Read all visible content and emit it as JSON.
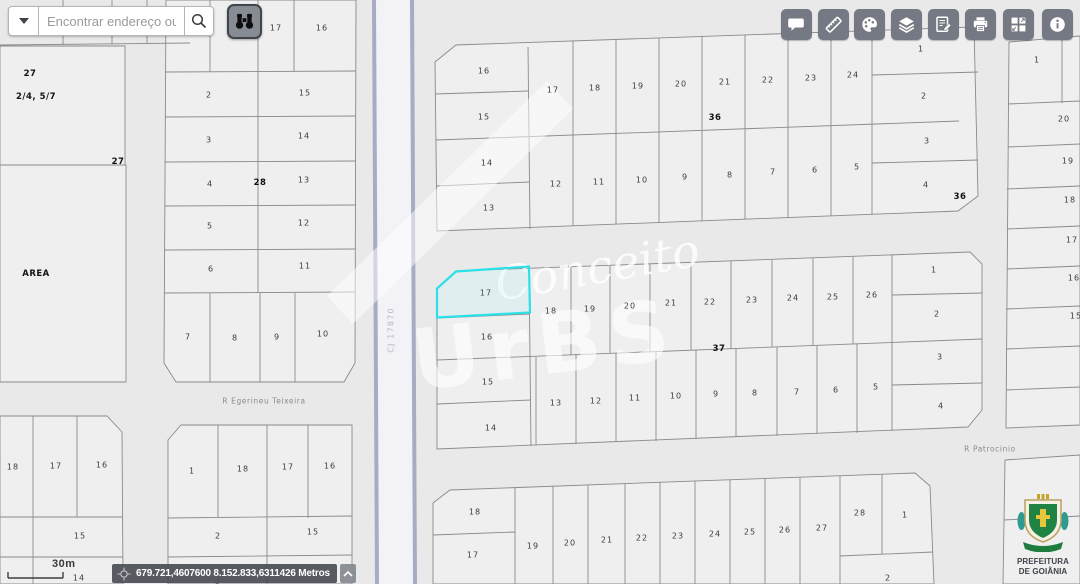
{
  "search": {
    "placeholder": "Encontrar endereço ou"
  },
  "toolbar": {
    "buttons": [
      "comment",
      "measure",
      "palette",
      "layers",
      "notes",
      "print",
      "mosaic",
      "info"
    ]
  },
  "binoculars_tool": "binoculars",
  "statusbar": {
    "scale_label": "30m",
    "coordinates": "679.721,4607600 8.152.833,6311426 Metros"
  },
  "watermark": {
    "script": "Conceito",
    "big": "UrBS"
  },
  "logo": {
    "line1": "PREFEITURA",
    "line2": "DE GOIÂNIA"
  },
  "colors": {
    "highlight": "#2ce0e8",
    "street_casing": "#a7abc4",
    "toolbar_button": "#757983"
  },
  "map": {
    "selected_lot": "17",
    "labels": [
      {
        "t": "27",
        "x": 30,
        "y": 74,
        "k": "block"
      },
      {
        "t": "2/4, 5/7",
        "x": 36,
        "y": 97,
        "k": "block"
      },
      {
        "t": "27",
        "x": 118,
        "y": 162,
        "k": "block"
      },
      {
        "t": "AREA",
        "x": 36,
        "y": 274,
        "k": "block"
      },
      {
        "t": "17",
        "x": 276,
        "y": 28
      },
      {
        "t": "16",
        "x": 322,
        "y": 28
      },
      {
        "t": "2",
        "x": 209,
        "y": 95
      },
      {
        "t": "15",
        "x": 305,
        "y": 93
      },
      {
        "t": "3",
        "x": 209,
        "y": 140
      },
      {
        "t": "14",
        "x": 304,
        "y": 136
      },
      {
        "t": "4",
        "x": 210,
        "y": 184
      },
      {
        "t": "28",
        "x": 260,
        "y": 183,
        "k": "block"
      },
      {
        "t": "13",
        "x": 304,
        "y": 180
      },
      {
        "t": "5",
        "x": 210,
        "y": 226
      },
      {
        "t": "12",
        "x": 304,
        "y": 223
      },
      {
        "t": "6",
        "x": 211,
        "y": 269
      },
      {
        "t": "11",
        "x": 305,
        "y": 266
      },
      {
        "t": "7",
        "x": 188,
        "y": 337
      },
      {
        "t": "8",
        "x": 235,
        "y": 338
      },
      {
        "t": "9",
        "x": 277,
        "y": 337
      },
      {
        "t": "10",
        "x": 323,
        "y": 334
      },
      {
        "t": "18",
        "x": 13,
        "y": 467
      },
      {
        "t": "17",
        "x": 56,
        "y": 466
      },
      {
        "t": "16",
        "x": 102,
        "y": 465
      },
      {
        "t": "15",
        "x": 80,
        "y": 536
      },
      {
        "t": "14",
        "x": 79,
        "y": 578
      },
      {
        "t": "1",
        "x": 192,
        "y": 471
      },
      {
        "t": "18",
        "x": 243,
        "y": 469
      },
      {
        "t": "17",
        "x": 288,
        "y": 467
      },
      {
        "t": "16",
        "x": 330,
        "y": 466
      },
      {
        "t": "2",
        "x": 218,
        "y": 536
      },
      {
        "t": "15",
        "x": 313,
        "y": 532
      },
      {
        "t": "3",
        "x": 218,
        "y": 581
      },
      {
        "t": "16",
        "x": 484,
        "y": 71
      },
      {
        "t": "15",
        "x": 484,
        "y": 117
      },
      {
        "t": "14",
        "x": 487,
        "y": 163
      },
      {
        "t": "13",
        "x": 489,
        "y": 208
      },
      {
        "t": "17",
        "x": 553,
        "y": 90
      },
      {
        "t": "18",
        "x": 595,
        "y": 88
      },
      {
        "t": "19",
        "x": 638,
        "y": 86
      },
      {
        "t": "20",
        "x": 681,
        "y": 84
      },
      {
        "t": "21",
        "x": 725,
        "y": 82
      },
      {
        "t": "22",
        "x": 768,
        "y": 80
      },
      {
        "t": "23",
        "x": 811,
        "y": 78
      },
      {
        "t": "24",
        "x": 853,
        "y": 75
      },
      {
        "t": "36",
        "x": 715,
        "y": 118,
        "k": "block"
      },
      {
        "t": "12",
        "x": 556,
        "y": 184
      },
      {
        "t": "11",
        "x": 599,
        "y": 182
      },
      {
        "t": "10",
        "x": 642,
        "y": 180
      },
      {
        "t": "9",
        "x": 685,
        "y": 177
      },
      {
        "t": "8",
        "x": 730,
        "y": 175
      },
      {
        "t": "7",
        "x": 773,
        "y": 172
      },
      {
        "t": "6",
        "x": 815,
        "y": 170
      },
      {
        "t": "5",
        "x": 857,
        "y": 167
      },
      {
        "t": "1",
        "x": 921,
        "y": 49
      },
      {
        "t": "2",
        "x": 924,
        "y": 96
      },
      {
        "t": "3",
        "x": 927,
        "y": 141
      },
      {
        "t": "4",
        "x": 926,
        "y": 185
      },
      {
        "t": "36",
        "x": 960,
        "y": 197,
        "k": "block"
      },
      {
        "t": "1",
        "x": 1037,
        "y": 60
      },
      {
        "t": "20",
        "x": 1064,
        "y": 119
      },
      {
        "t": "19",
        "x": 1068,
        "y": 161
      },
      {
        "t": "18",
        "x": 1070,
        "y": 200
      },
      {
        "t": "17",
        "x": 1072,
        "y": 240
      },
      {
        "t": "16",
        "x": 1074,
        "y": 278
      },
      {
        "t": "15",
        "x": 1076,
        "y": 316
      },
      {
        "t": "17",
        "x": 486,
        "y": 293
      },
      {
        "t": "16",
        "x": 487,
        "y": 337
      },
      {
        "t": "15",
        "x": 488,
        "y": 382
      },
      {
        "t": "14",
        "x": 491,
        "y": 428
      },
      {
        "t": "18",
        "x": 551,
        "y": 311
      },
      {
        "t": "19",
        "x": 590,
        "y": 309
      },
      {
        "t": "20",
        "x": 630,
        "y": 306
      },
      {
        "t": "21",
        "x": 671,
        "y": 303
      },
      {
        "t": "22",
        "x": 710,
        "y": 302
      },
      {
        "t": "23",
        "x": 752,
        "y": 300
      },
      {
        "t": "24",
        "x": 793,
        "y": 298
      },
      {
        "t": "25",
        "x": 833,
        "y": 297
      },
      {
        "t": "26",
        "x": 872,
        "y": 295
      },
      {
        "t": "37",
        "x": 719,
        "y": 349,
        "k": "block"
      },
      {
        "t": "13",
        "x": 556,
        "y": 403
      },
      {
        "t": "12",
        "x": 596,
        "y": 401
      },
      {
        "t": "11",
        "x": 635,
        "y": 398
      },
      {
        "t": "10",
        "x": 676,
        "y": 396
      },
      {
        "t": "9",
        "x": 716,
        "y": 394
      },
      {
        "t": "8",
        "x": 755,
        "y": 393
      },
      {
        "t": "7",
        "x": 797,
        "y": 392
      },
      {
        "t": "6",
        "x": 836,
        "y": 390
      },
      {
        "t": "5",
        "x": 876,
        "y": 387
      },
      {
        "t": "1",
        "x": 934,
        "y": 270
      },
      {
        "t": "2",
        "x": 937,
        "y": 314
      },
      {
        "t": "3",
        "x": 940,
        "y": 357
      },
      {
        "t": "4",
        "x": 941,
        "y": 406
      },
      {
        "t": "18",
        "x": 475,
        "y": 512
      },
      {
        "t": "17",
        "x": 473,
        "y": 555
      },
      {
        "t": "19",
        "x": 533,
        "y": 546
      },
      {
        "t": "20",
        "x": 570,
        "y": 543
      },
      {
        "t": "21",
        "x": 607,
        "y": 540
      },
      {
        "t": "22",
        "x": 642,
        "y": 538
      },
      {
        "t": "23",
        "x": 678,
        "y": 536
      },
      {
        "t": "24",
        "x": 715,
        "y": 534
      },
      {
        "t": "25",
        "x": 750,
        "y": 532
      },
      {
        "t": "26",
        "x": 785,
        "y": 530
      },
      {
        "t": "27",
        "x": 822,
        "y": 528
      },
      {
        "t": "28",
        "x": 860,
        "y": 513
      },
      {
        "t": "1",
        "x": 905,
        "y": 515
      },
      {
        "t": "2",
        "x": 888,
        "y": 578
      },
      {
        "t": "R Egerineu Teixeira",
        "x": 264,
        "y": 401,
        "k": "street"
      },
      {
        "t": "R Patrocinio",
        "x": 990,
        "y": 449,
        "k": "street"
      },
      {
        "t": "CJ 17870",
        "x": 391,
        "y": 330,
        "k": "cj",
        "r": -90
      }
    ]
  }
}
